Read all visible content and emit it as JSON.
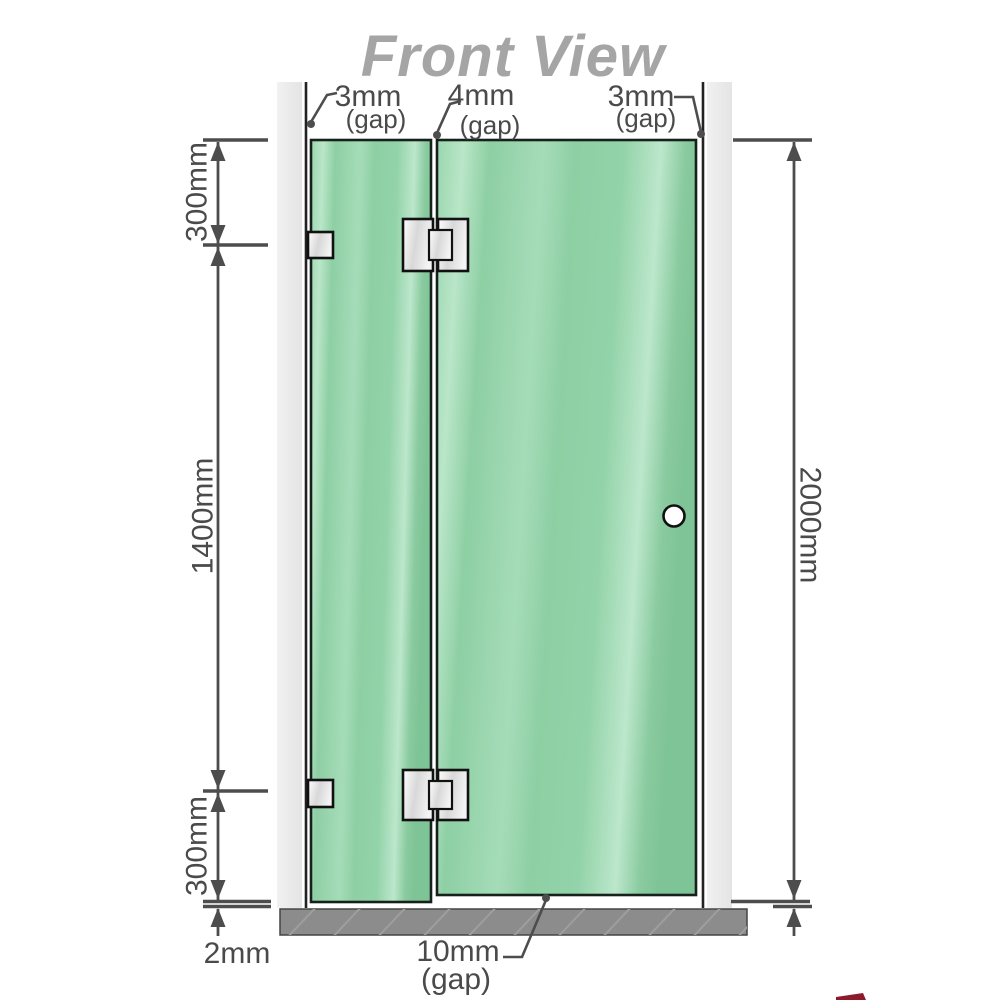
{
  "title": "Front View",
  "diagram": {
    "type": "shower-screen-front-elevation",
    "labels": {
      "top_gap_left": {
        "value": "3mm",
        "note": "(gap)"
      },
      "top_gap_middle": {
        "value": "4mm",
        "note": "(gap)"
      },
      "top_gap_right": {
        "value": "3mm",
        "note": "(gap)"
      },
      "left_segment_top": "300mm",
      "left_segment_middle": "1400mm",
      "left_segment_bottom": "300mm",
      "left_floor_gap": "2mm",
      "right_total_height": "2000mm",
      "bottom_door_gap": {
        "value": "10mm",
        "note": "(gap)"
      }
    },
    "colors": {
      "glass_green": "#8ecfa4",
      "glass_highlight": "#bce7cb",
      "wall_gray": "#ebebeb",
      "floor_gray": "#8c8c8c",
      "dimension_gray": "#4d4d4d",
      "title_gray": "#a5a5a5"
    }
  }
}
